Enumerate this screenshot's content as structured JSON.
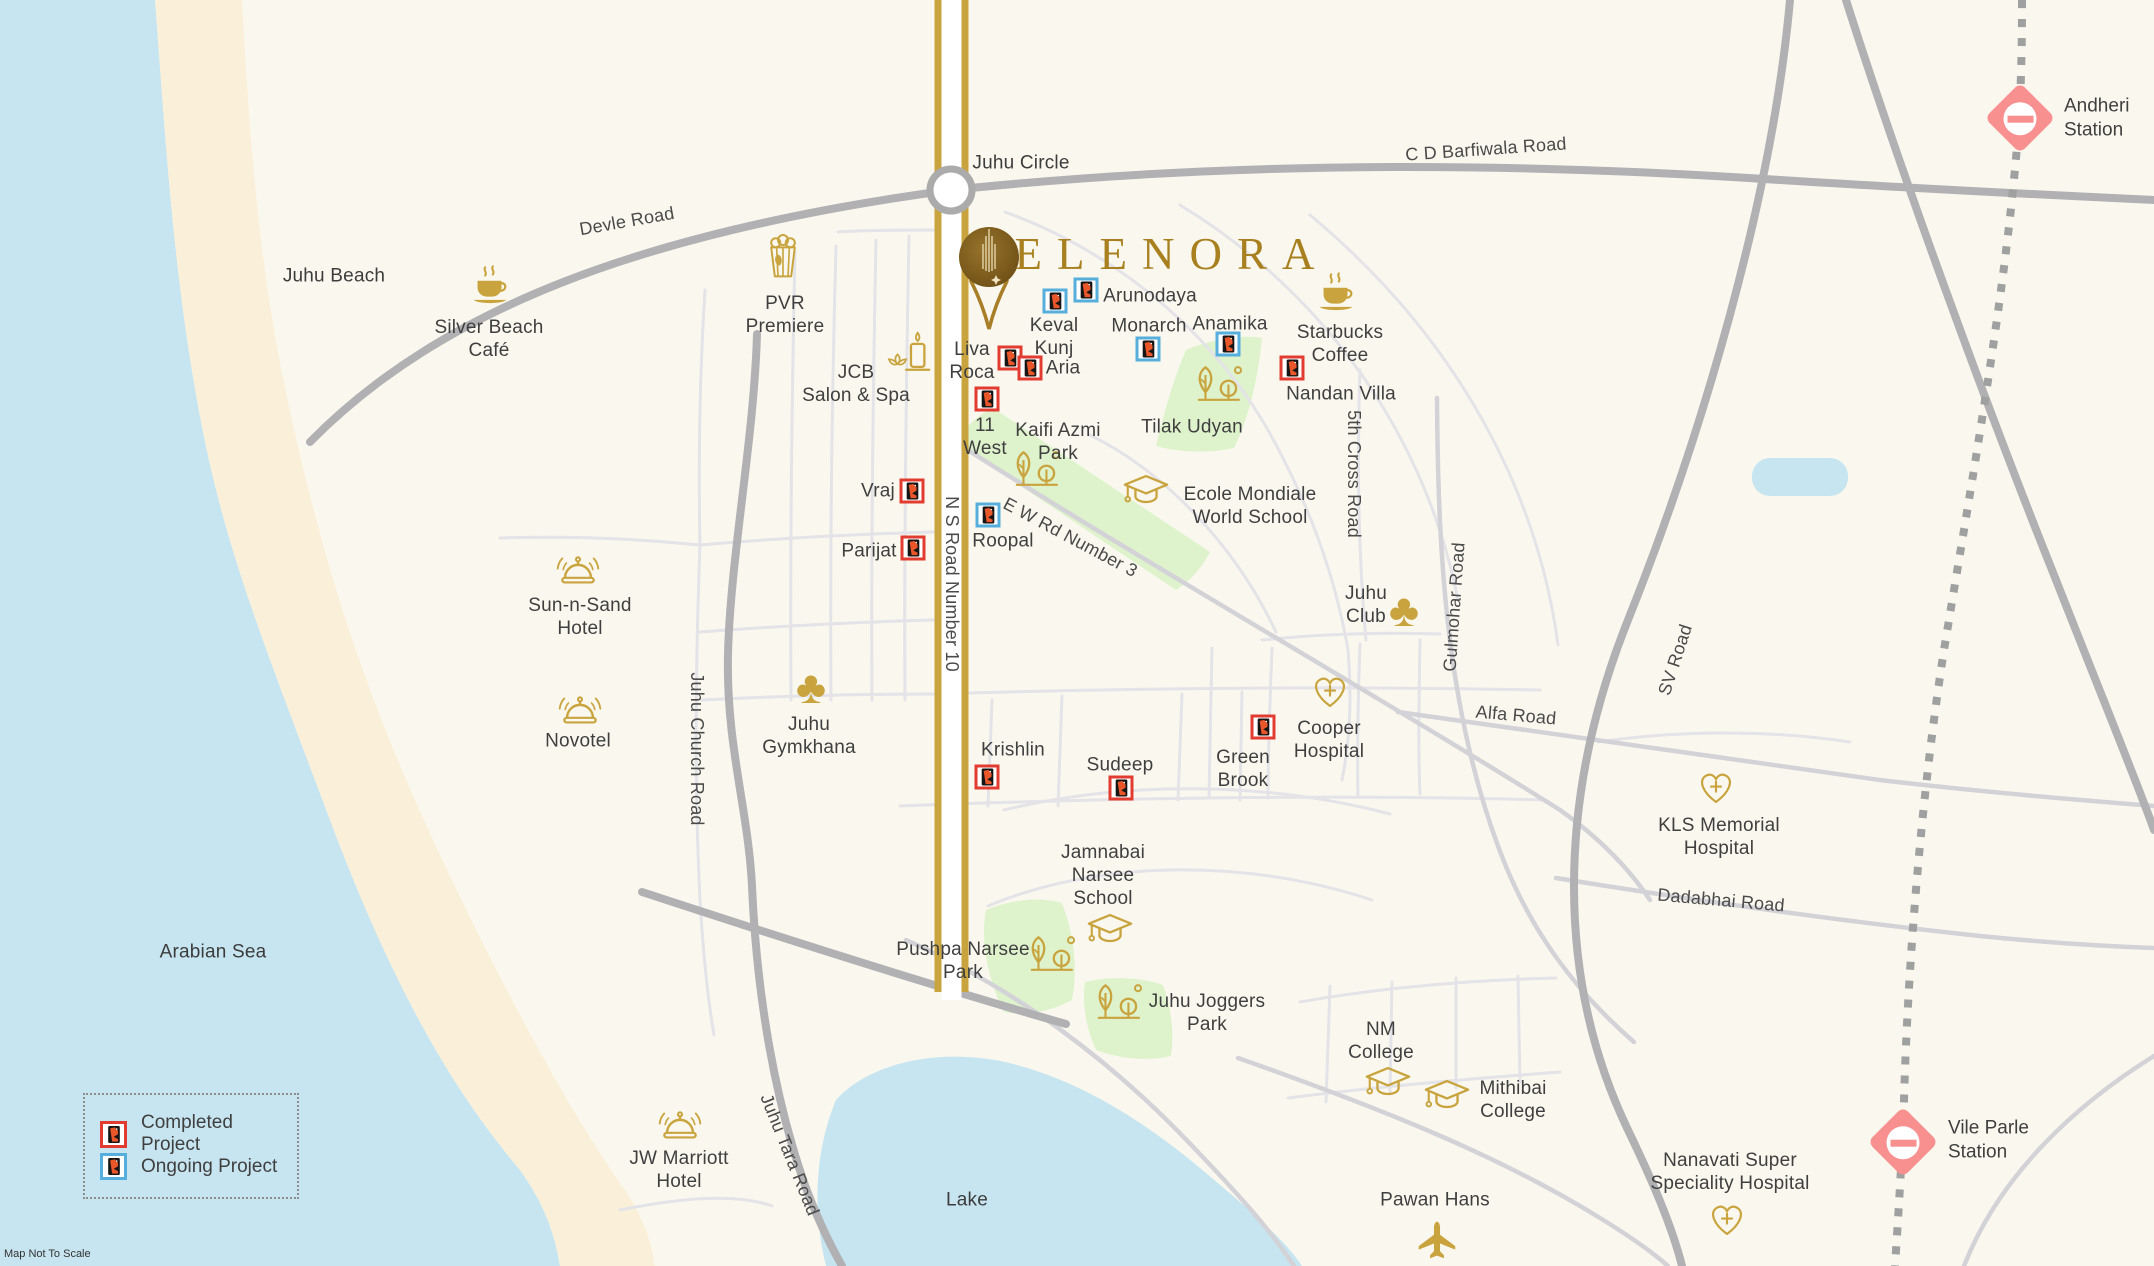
{
  "page": {
    "map_note": "Map Not To Scale"
  },
  "logo": {
    "text": "ELENORA"
  },
  "legend": {
    "completed": "Completed Project",
    "ongoing": "Ongoing Project"
  },
  "colors": {
    "sea": "#C7E5F0",
    "sand": "#FAF0DA",
    "land": "#FAF8EE",
    "park": "#DEF2CC",
    "gold": "#C9A43E",
    "logo_gold": "#A8801F",
    "completed": "#E23B30",
    "ongoing": "#56AEDC",
    "station_pink": "#F89090",
    "text": "#3F3F3F"
  },
  "areas": [
    {
      "name": "juhu-beach",
      "label": "Juhu Beach",
      "x": 334,
      "y": 276
    },
    {
      "name": "arabian-sea",
      "label": "Arabian Sea",
      "x": 213,
      "y": 952
    },
    {
      "name": "lake",
      "label": "Lake",
      "x": 967,
      "y": 1200
    },
    {
      "name": "juhu-circle",
      "label": "Juhu Circle",
      "x": 1021,
      "y": 163
    }
  ],
  "road_labels": [
    {
      "name": "devle-road",
      "label": "Devle Road",
      "x": 627,
      "y": 222,
      "rot": -10
    },
    {
      "name": "cd-barfiwala-road",
      "label": "C D Barfiwala Road",
      "x": 1486,
      "y": 150,
      "rot": -4
    },
    {
      "name": "ns-road-number-10",
      "label": "N S Road Number 10",
      "x": 951,
      "y": 584,
      "rot": 90
    },
    {
      "name": "ew-rd-number-3",
      "label": "E W Rd Number 3",
      "x": 1070,
      "y": 538,
      "rot": 28
    },
    {
      "name": "5th-cross-road",
      "label": "5th Cross Road",
      "x": 1353,
      "y": 474,
      "rot": 90
    },
    {
      "name": "gulmohar-road",
      "label": "Gulmohar Road",
      "x": 1455,
      "y": 607,
      "rot": -86
    },
    {
      "name": "alfa-road",
      "label": "Alfa Road",
      "x": 1516,
      "y": 716,
      "rot": 5
    },
    {
      "name": "sv-road",
      "label": "SV Road",
      "x": 1676,
      "y": 660,
      "rot": -72
    },
    {
      "name": "dadabhai-road",
      "label": "Dadabhai Road",
      "x": 1721,
      "y": 901,
      "rot": 5
    },
    {
      "name": "juhu-church-road",
      "label": "Juhu Church Road",
      "x": 696,
      "y": 749,
      "rot": 90
    },
    {
      "name": "juhu-tara-road",
      "label": "Juhu Tara Road",
      "x": 789,
      "y": 1155,
      "rot": 68
    }
  ],
  "landmarks": [
    {
      "name": "silver-beach-cafe",
      "icon": "coffee",
      "label": "Silver Beach\nCafé",
      "ix": 490,
      "iy": 289,
      "lx": 489,
      "ly": 339
    },
    {
      "name": "pvr-premiere",
      "icon": "popcorn",
      "label": "PVR\nPremiere",
      "ix": 783,
      "iy": 258,
      "lx": 785,
      "ly": 315
    },
    {
      "name": "jcb-salon-spa",
      "icon": "spa",
      "label": "JCB\nSalon & Spa",
      "ix": 910,
      "iy": 355,
      "lx": 856,
      "ly": 384
    },
    {
      "name": "starbucks-coffee",
      "icon": "coffee",
      "label": "Starbucks\nCoffee",
      "ix": 1336,
      "iy": 296,
      "lx": 1340,
      "ly": 344
    },
    {
      "name": "tilak-udyan",
      "icon": "tree",
      "label": "Tilak Udyan",
      "ix": 1216,
      "iy": 388,
      "lx": 1192,
      "ly": 427
    },
    {
      "name": "kaifi-azmi-park",
      "icon": "tree",
      "label": "Kaifi Azmi\nPark",
      "ix": 1034,
      "iy": 473,
      "lx": 1058,
      "ly": 442
    },
    {
      "name": "ecole-mondiale",
      "icon": "grad-cap",
      "label": "Ecole Mondiale\nWorld School",
      "ix": 1146,
      "iy": 493,
      "lx": 1250,
      "ly": 506
    },
    {
      "name": "juhu-club",
      "icon": "club",
      "label": "Juhu\nClub",
      "ix": 1404,
      "iy": 610,
      "lx": 1366,
      "ly": 605
    },
    {
      "name": "sun-n-sand-hotel",
      "icon": "bell",
      "label": "Sun-n-Sand\nHotel",
      "ix": 578,
      "iy": 572,
      "lx": 580,
      "ly": 617
    },
    {
      "name": "novotel",
      "icon": "bell",
      "label": "Novotel",
      "ix": 580,
      "iy": 712,
      "lx": 578,
      "ly": 741
    },
    {
      "name": "juhu-gymkhana",
      "icon": "club",
      "label": "Juhu\nGymkhana",
      "ix": 811,
      "iy": 687,
      "lx": 809,
      "ly": 736
    },
    {
      "name": "cooper-hospital",
      "icon": "heart-cross",
      "label": "Cooper\nHospital",
      "ix": 1330,
      "iy": 694,
      "lx": 1329,
      "ly": 740
    },
    {
      "name": "kls-memorial",
      "icon": "heart-cross",
      "label": "KLS Memorial\nHospital",
      "ix": 1716,
      "iy": 790,
      "lx": 1719,
      "ly": 837
    },
    {
      "name": "jamnabai-narsee",
      "icon": "grad-cap",
      "label": "Jamnabai\nNarsee\nSchool",
      "ix": 1110,
      "iy": 932,
      "lx": 1103,
      "ly": 876
    },
    {
      "name": "pushpa-narsee-park",
      "icon": "tree",
      "label": "Pushpa Narsee\nPark",
      "ix": 1049,
      "iy": 958,
      "lx": 963,
      "ly": 961
    },
    {
      "name": "juhu-joggers-park",
      "icon": "tree",
      "label": "Juhu Joggers\nPark",
      "ix": 1116,
      "iy": 1006,
      "lx": 1207,
      "ly": 1013
    },
    {
      "name": "nm-college",
      "icon": "grad-cap",
      "label": "NM\nCollege",
      "ix": 1388,
      "iy": 1085,
      "lx": 1381,
      "ly": 1041
    },
    {
      "name": "mithibai-college",
      "icon": "grad-cap",
      "label": "Mithibai\nCollege",
      "ix": 1447,
      "iy": 1098,
      "lx": 1513,
      "ly": 1100
    },
    {
      "name": "jw-marriott-hotel",
      "icon": "bell",
      "label": "JW Marriott\nHotel",
      "ix": 680,
      "iy": 1127,
      "lx": 679,
      "ly": 1170
    },
    {
      "name": "pawan-hans",
      "icon": "plane",
      "label": "Pawan Hans",
      "ix": 1437,
      "iy": 1242,
      "lx": 1435,
      "ly": 1200
    },
    {
      "name": "nanavati-hospital",
      "icon": "heart-cross",
      "label": "Nanavati Super\nSpeciality Hospital",
      "ix": 1727,
      "iy": 1222,
      "lx": 1730,
      "ly": 1172
    }
  ],
  "projects": [
    {
      "name": "liva-roca",
      "label": "Liva\nRoca",
      "status": "completed",
      "mx": 1010,
      "my": 358,
      "lx": 972,
      "ly": 361
    },
    {
      "name": "aria",
      "label": "Aria",
      "status": "completed",
      "mx": 1030,
      "my": 368,
      "lx": 1063,
      "ly": 368
    },
    {
      "name": "11-west",
      "label": "11\nWest",
      "status": "completed",
      "mx": 987,
      "my": 399,
      "lx": 985,
      "ly": 437
    },
    {
      "name": "vraj",
      "label": "Vraj",
      "status": "completed",
      "mx": 912,
      "my": 491,
      "lx": 878,
      "ly": 491
    },
    {
      "name": "parijat",
      "label": "Parijat",
      "status": "completed",
      "mx": 913,
      "my": 548,
      "lx": 869,
      "ly": 551
    },
    {
      "name": "nandan-villa",
      "label": "Nandan Villa",
      "status": "completed",
      "mx": 1292,
      "my": 368,
      "lx": 1341,
      "ly": 394
    },
    {
      "name": "green-brook",
      "label": "Green\nBrook",
      "status": "completed",
      "mx": 1263,
      "my": 727,
      "lx": 1243,
      "ly": 769
    },
    {
      "name": "krishlin",
      "label": "Krishlin",
      "status": "completed",
      "mx": 987,
      "my": 777,
      "lx": 1013,
      "ly": 750
    },
    {
      "name": "sudeep",
      "label": "Sudeep",
      "status": "completed",
      "mx": 1121,
      "my": 788,
      "lx": 1120,
      "ly": 765
    },
    {
      "name": "keval-kunj",
      "label": "Keval\nKunj",
      "status": "ongoing",
      "mx": 1055,
      "my": 301,
      "lx": 1054,
      "ly": 337
    },
    {
      "name": "arunodaya",
      "label": "Arunodaya",
      "status": "ongoing",
      "mx": 1086,
      "my": 290,
      "lx": 1150,
      "ly": 296
    },
    {
      "name": "monarch",
      "label": "Monarch",
      "status": "ongoing",
      "mx": 1148,
      "my": 349,
      "lx": 1149,
      "ly": 326
    },
    {
      "name": "anamika",
      "label": "Anamika",
      "status": "ongoing",
      "mx": 1228,
      "my": 344,
      "lx": 1230,
      "ly": 324
    },
    {
      "name": "roopal",
      "label": "Roopal",
      "status": "ongoing",
      "mx": 988,
      "my": 515,
      "lx": 1003,
      "ly": 541
    }
  ],
  "stations": [
    {
      "name": "andheri-station",
      "label": "Andheri\nStation",
      "x": 2020,
      "y": 118,
      "lx": 2064,
      "ly": 118
    },
    {
      "name": "vile-parle-station",
      "label": "Vile Parle\nStation",
      "x": 1903,
      "y": 1142,
      "lx": 1948,
      "ly": 1140
    }
  ]
}
